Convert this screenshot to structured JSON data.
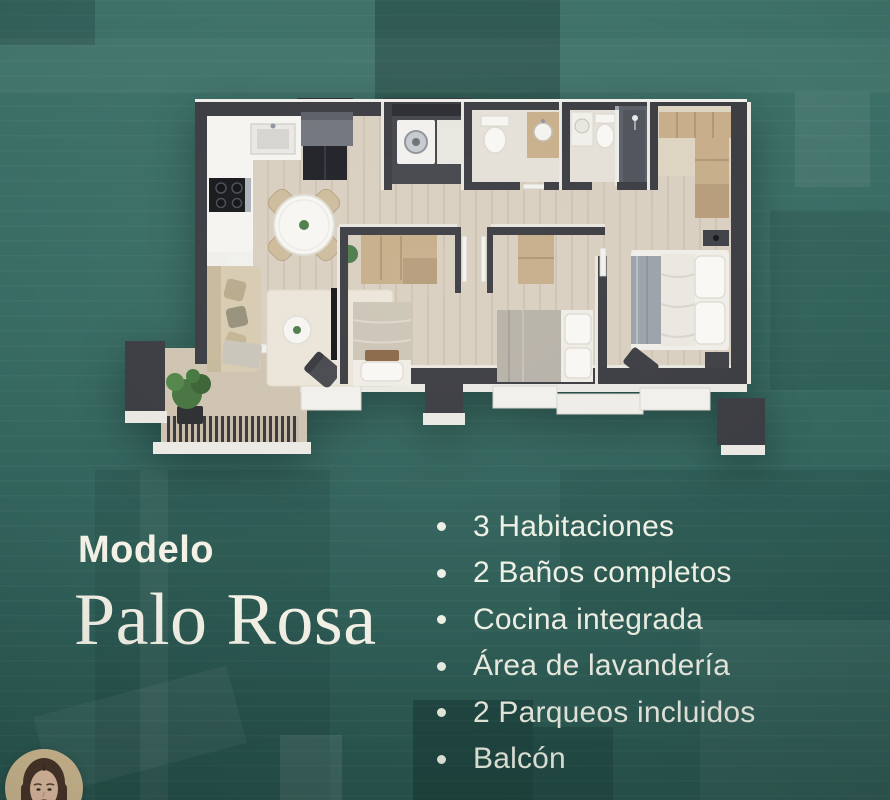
{
  "flyer": {
    "model_label": "Modelo",
    "model_name": "Palo Rosa",
    "features": {
      "bullet_icon": "dot",
      "items": [
        {
          "label": "3 Habitaciones"
        },
        {
          "label": "2 Baños completos"
        },
        {
          "label": "Cocina integrada"
        },
        {
          "label": "Área de lavandería"
        },
        {
          "label": "2 Parqueos incluidos"
        },
        {
          "label": "Balcón"
        }
      ]
    },
    "colors": {
      "background_teal": "#35665e",
      "text_cream": "#f2f0e4",
      "floorplan_wall": "#3b3c41",
      "floorplan_floor": "#d9cfc0",
      "cabinet_wood": "#c7ad89",
      "duvet_gray": "#9aa1aa"
    }
  }
}
